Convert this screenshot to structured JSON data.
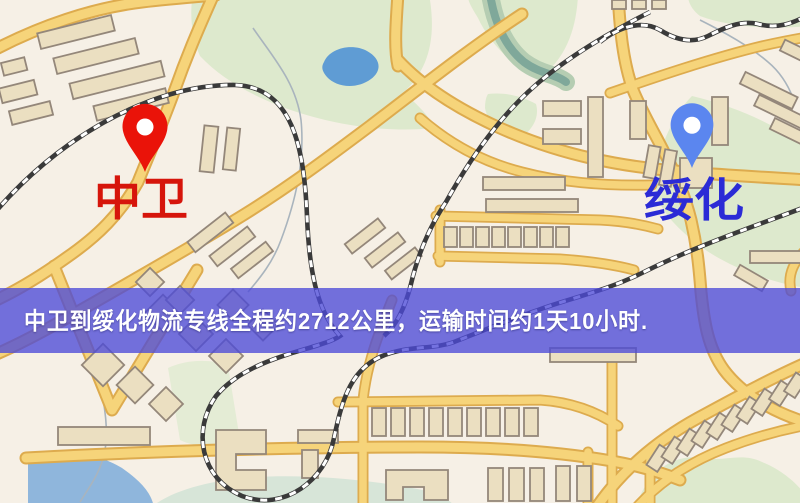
{
  "map": {
    "origin": {
      "name": "中卫",
      "pin_color": "#ea1309",
      "label_color": "#d6150b"
    },
    "destination": {
      "name": "绥化",
      "pin_color": "#5b86ef",
      "label_color": "#2b2bd6"
    },
    "route": {
      "distance_text": "2712公里",
      "duration_text": "1天10小时"
    },
    "banner": {
      "text": "中卫到绥化物流专线全程约2712公里，运输时间约1天10小时.",
      "bg_color": "#4d4ad7",
      "text_color": "#ffffff"
    },
    "colors": {
      "land": "#f6f0e6",
      "road_fill": "#f6d47a",
      "road_edge": "#ddab4e",
      "park": "#dde9cd",
      "lake": "#5f9cd4",
      "building_fill": "#ebdfc1",
      "railway": "#3a3a3a"
    }
  }
}
